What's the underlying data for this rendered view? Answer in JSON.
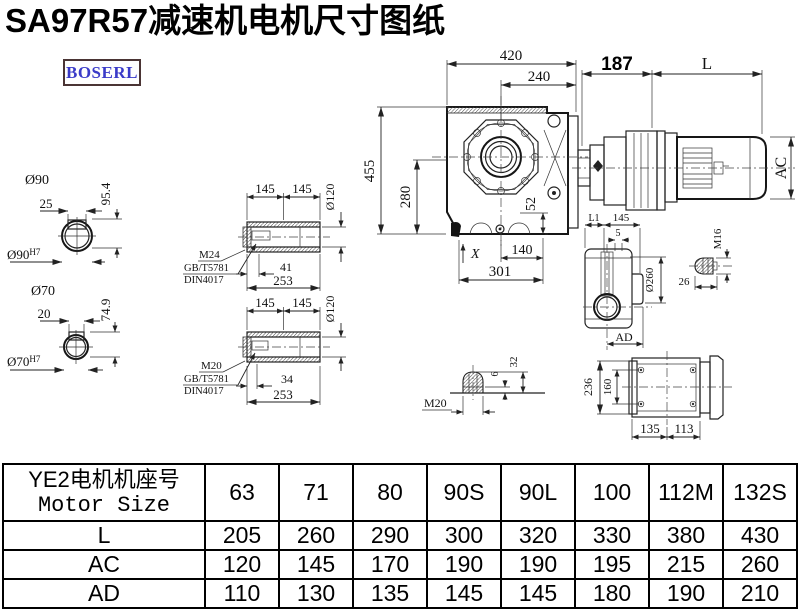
{
  "title": "SA97R57减速机电机尺寸图纸",
  "logo": "BOSERL",
  "drawing": {
    "front_view": {
      "w420": "420",
      "w240": "240",
      "h455": "455",
      "h280": "280",
      "h52": "52",
      "w140": "140",
      "w301": "301",
      "x_mark": "X"
    },
    "assembly": {
      "adapter_len": "187",
      "motor_len": "L",
      "motor_dia": "AC"
    },
    "hole90": {
      "dia": "Ø90",
      "key_w": "25",
      "key_h": "95.4",
      "fit_base": "Ø90",
      "fit_sup": "H7"
    },
    "hole70": {
      "dia": "Ø70",
      "key_w": "20",
      "key_h": "74.9",
      "fit_base": "Ø70",
      "fit_sup": "H7"
    },
    "bushing_m24": {
      "len_a": "145",
      "len_b": "145",
      "bore": "Ø120",
      "bolt": "M24",
      "std1": "GB/T5781",
      "std2": "DIN4017",
      "bolt_len": "41",
      "total": "253"
    },
    "bushing_m20": {
      "len_a": "145",
      "len_b": "145",
      "bore": "Ø120",
      "bolt": "M20",
      "std1": "GB/T5781",
      "std2": "DIN4017",
      "bolt_len": "34",
      "total": "253"
    },
    "side_view": {
      "l1": "L1",
      "w145": "145",
      "w5": "5",
      "dia260": "Ø260",
      "ad": "AD"
    },
    "plug_m16": {
      "label": "M16",
      "len": "26"
    },
    "plug_m20": {
      "label": "M20",
      "h6": "6",
      "h32": "32"
    },
    "bottom_view": {
      "h236": "236",
      "h160": "160",
      "w135": "135",
      "w113": "113"
    }
  },
  "table": {
    "header_line1": "YE2电机机座号",
    "header_line2": "Motor Size",
    "sizes": [
      "63",
      "71",
      "80",
      "90S",
      "90L",
      "100",
      "112M",
      "132S"
    ],
    "rows": [
      {
        "label": "L",
        "values": [
          "205",
          "260",
          "290",
          "300",
          "320",
          "330",
          "380",
          "430"
        ]
      },
      {
        "label": "AC",
        "values": [
          "120",
          "145",
          "170",
          "190",
          "190",
          "195",
          "215",
          "260"
        ]
      },
      {
        "label": "AD",
        "values": [
          "110",
          "130",
          "135",
          "145",
          "145",
          "180",
          "190",
          "210"
        ]
      }
    ]
  }
}
